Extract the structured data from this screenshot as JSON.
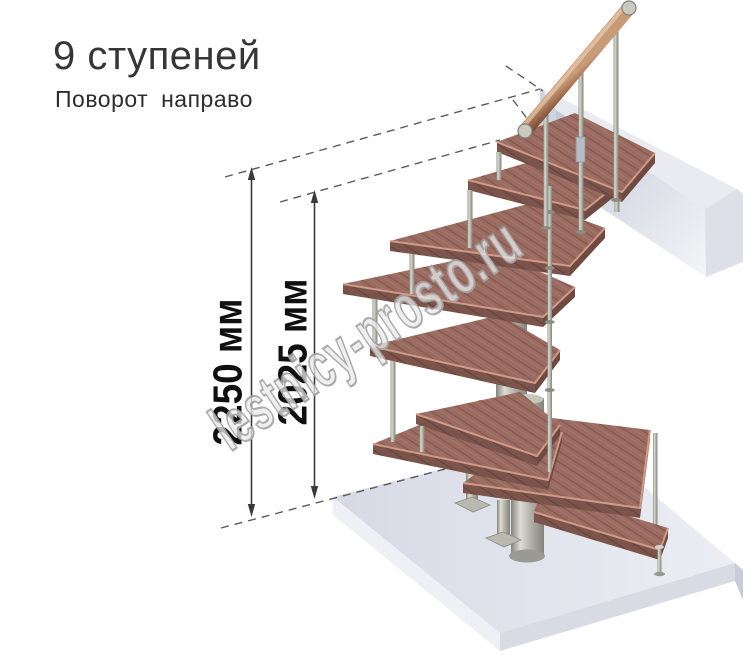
{
  "header": {
    "title": "9 ступеней",
    "subtitle": "Поворот направо"
  },
  "dimensions": {
    "total_height": {
      "label": "2250 мм"
    },
    "to_top_platform": {
      "label": "2025 мм"
    }
  },
  "watermark": {
    "text": "lestnicy-prosto.ru"
  },
  "illustration": {
    "type": "3d-render",
    "subject": "modular winder staircase",
    "steps_count": 9,
    "turn_direction": "right",
    "colors": {
      "step_wood": "#9a6b61",
      "step_wood_edge": "#d09a87",
      "step_wood_front": "#7b544c",
      "handrail_wood": "#a3724f",
      "metal": "#b5b5ad",
      "floor_slab_light": "#e9ebf2",
      "floor_slab_mid": "#d6d9e4",
      "dimension_line": "#3a3a3a",
      "dashed_line": "#5f5a56",
      "watermark_gray": "#b3b3b3"
    }
  }
}
